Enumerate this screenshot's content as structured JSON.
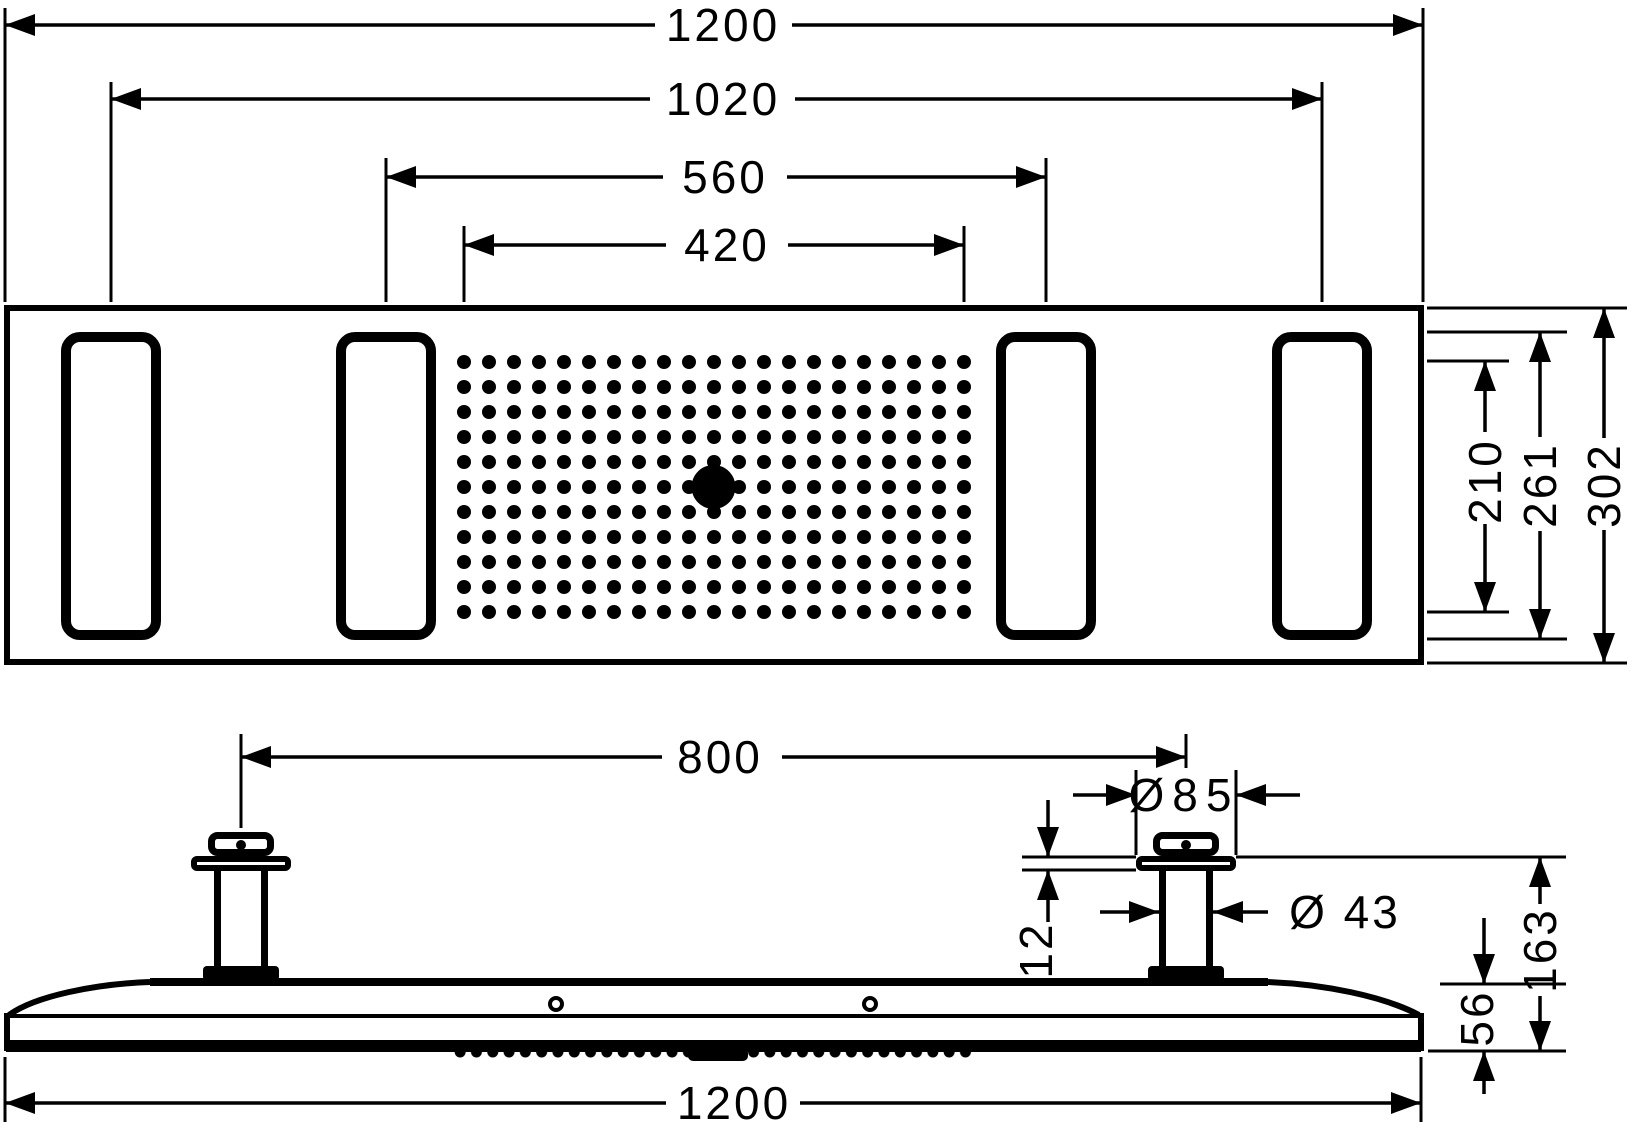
{
  "colors": {
    "background": "#ffffff",
    "line": "#000000"
  },
  "views": {
    "top": {
      "label": "top-view",
      "dims": {
        "overall_width": "1200",
        "outer_lamps_span": "1020",
        "inner_lamps_span": "560",
        "spray_field_width": "420",
        "spray_field_depth": "210",
        "lamp_length": "261",
        "overall_depth": "302"
      }
    },
    "side": {
      "label": "side-view",
      "dims": {
        "connector_span": "800",
        "escutcheon_diameter": "Ø85",
        "pipe_diameter": "Ø 43",
        "escutcheon_height": "12",
        "total_height": "163",
        "body_height": "56",
        "overall_width": "1200"
      }
    }
  }
}
